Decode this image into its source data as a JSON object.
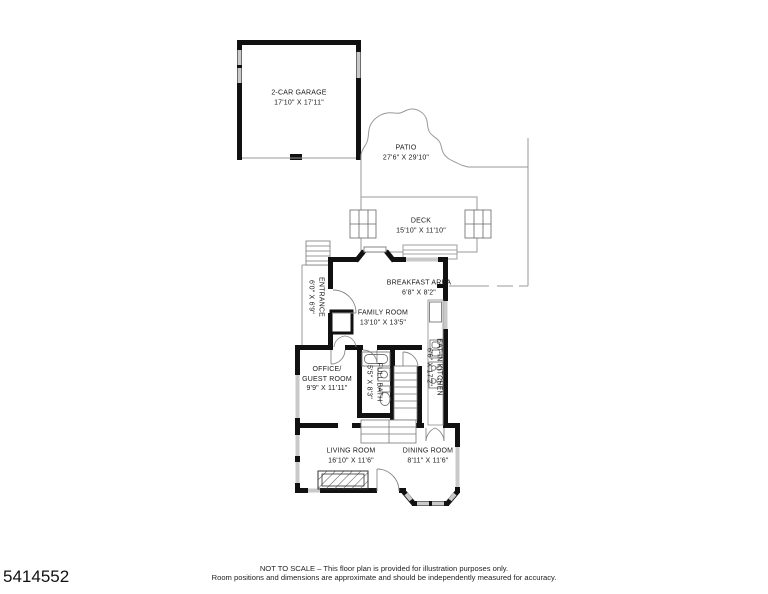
{
  "plan": {
    "garage": {
      "name": "2-CAR GARAGE",
      "dims": "17'10\" X 17'11\""
    },
    "patio": {
      "name": "PATIO",
      "dims": "27'6\" X 29'10\""
    },
    "deck": {
      "name": "DECK",
      "dims": "15'10\" X 11'10\""
    },
    "entrance": {
      "name": "ENTRANCE",
      "dims": "6'0\" X 6'9\""
    },
    "breakfast": {
      "name": "BREAKFAST AREA",
      "dims": "6'8\" X 8'2\""
    },
    "family": {
      "name": "FAMILY ROOM",
      "dims": "13'10\" X 13'5\""
    },
    "kitchen": {
      "name": "EAT-IN KITCHEN",
      "dims": "6'6\" X 17'2\""
    },
    "office": {
      "name_line1": "OFFICE/",
      "name_line2": "GUEST ROOM",
      "dims": "9'9\" X 11'11\""
    },
    "bath": {
      "name": "FULL BATH",
      "dims": "5'5\" X 8'3\""
    },
    "living": {
      "name": "LIVING ROOM",
      "dims": "16'10\" X 11'6\""
    },
    "dining": {
      "name": "DINING ROOM",
      "dims": "8'11\" X 11'6\""
    }
  },
  "footer": {
    "line1": "NOT TO SCALE – This floor plan is provided for illustration purposes only.",
    "line2": "Room positions and dimensions are approximate and should be independently measured for accuracy."
  },
  "listing_id": "5414552",
  "colors": {
    "wall": "#111111",
    "window": "#c9c9c9",
    "thin_line": "#999999",
    "text": "#1a1a1a"
  }
}
